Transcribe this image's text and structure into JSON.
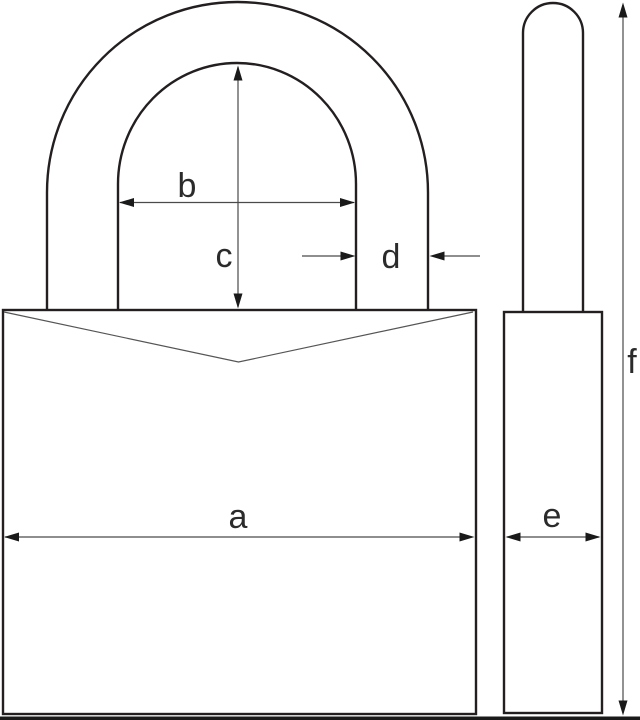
{
  "diagram": {
    "type": "padlock-dimensional-drawing",
    "dimension_labels": {
      "a": "a",
      "b": "b",
      "c": "c",
      "d": "d",
      "e": "e",
      "f": "f"
    },
    "colors": {
      "background": "#ffffff",
      "outline": "#231f20",
      "dimension_line": "#4a4a4a",
      "arrowhead": "#1a1a1a",
      "label_text": "#2b2b2b",
      "chamfer_line": "#555555",
      "bottom_bar": "#1a1a1a"
    }
  }
}
